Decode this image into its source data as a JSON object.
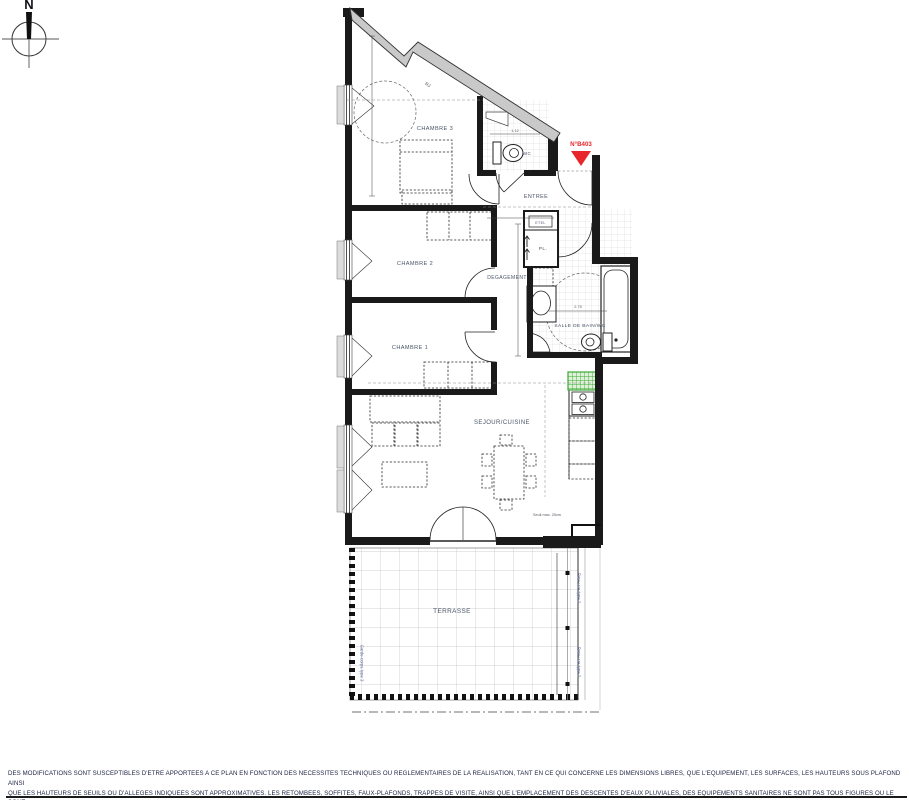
{
  "compass": {
    "north_label": "N"
  },
  "plan": {
    "unit": {
      "number": "N°B403",
      "color": "#e8252a"
    },
    "rooms": {
      "chambre3": "CHAMBRE 3",
      "chambre2": "CHAMBRE 2",
      "chambre1": "CHAMBRE 1",
      "entree": "ENTREE",
      "degagement": "DEGAGEMENT",
      "wc": "WC",
      "etel": "ETEL",
      "placard": "PL.",
      "salle_de_bain": "SALLE DE BAIN/WC",
      "sejour_cuisine": "SEJOUR/CUISINE",
      "terrasse": "TERRASSE"
    },
    "annotations": {
      "seuil": "Seuil max. 25cm",
      "garde_corps": "Garde-corps type 3",
      "pare_vue": "Pare-vue type 2",
      "roof_label": "RJ",
      "dim_wc": "1.12",
      "dim_bain": "2.75"
    },
    "colors": {
      "wall_black": "#1a1a1a",
      "band_gray": "#c9c9c9",
      "duct_green": "#3aaa35",
      "marker_red": "#e8252a"
    }
  },
  "footer": {
    "line1": "DES MODIFICATIONS SONT SUSCEPTIBLES D'ETRE APPORTEES A CE PLAN EN FONCTION DES NECESSITES TECHNIQUES OU REGLEMENTAIRES DE LA REALISATION, TANT EN CE QUI CONCERNE LES DIMENSIONS LIBRES, QUE L'EQUIPEMENT, LES SURFACES, LES HAUTEURS SOUS PLAFOND AINSI",
    "line2": "QUE LES HAUTEURS DE SEUILS OU D'ALLEGES INDIQUEES SONT APPROXIMATIVES. LES RETOMBEES, SOFFITES, FAUX-PLAFONDS, TRAPPES DE VISITE, AINSI QUE L'EMPLACEMENT DES DESCENTES D'EAUX PLUVIALES, DES EQUIPEMENTS SANITAIRES NE SONT PAS TOUS FIGURES OU LE SONT",
    "line3": "A TITRE INDICATIF. LES EQUIPEMENTS SANITAIRES FIGURANT EN POINTILLES SUR CE PLAN NE SONT REPRESENTES QU'A TITRE INDICATIF."
  }
}
